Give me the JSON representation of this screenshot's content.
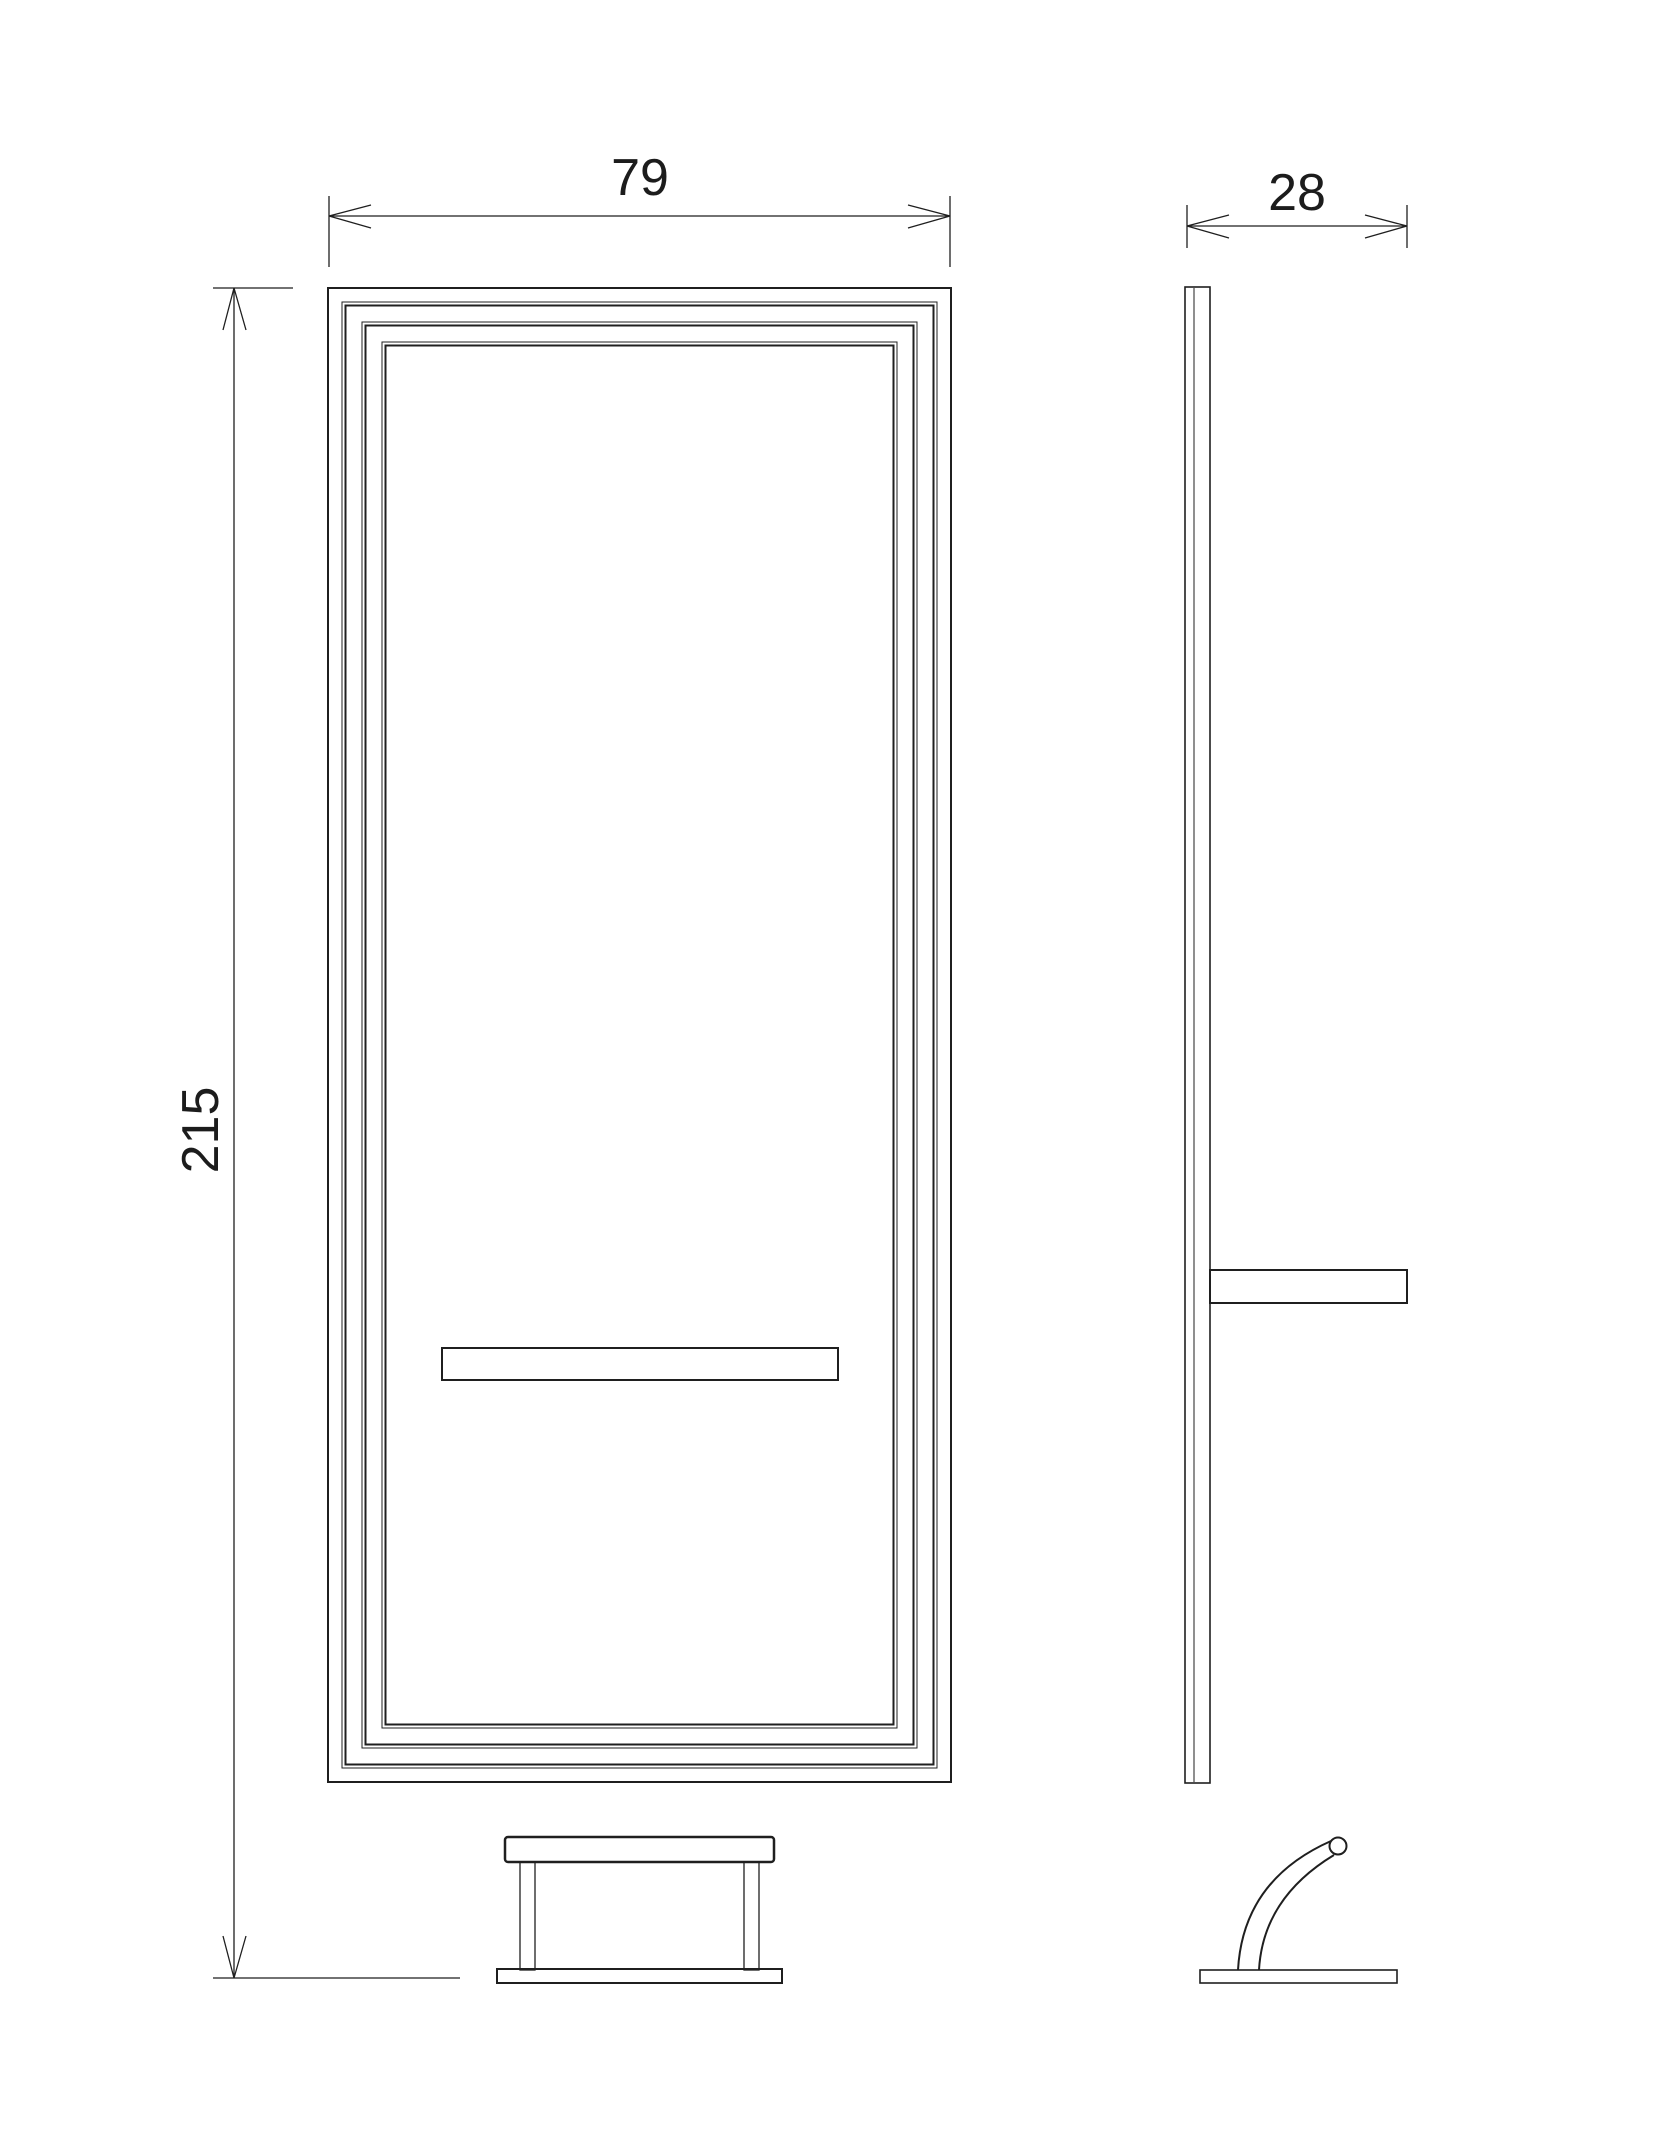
{
  "drawing": {
    "kind": "furniture-dimension-drawing",
    "colors": {
      "line": "#1f1f1f",
      "background": "#ffffff"
    },
    "dimensions": {
      "front_width": {
        "value": "79"
      },
      "overall_height": {
        "value": "215"
      },
      "side_depth": {
        "value": "28"
      }
    }
  }
}
